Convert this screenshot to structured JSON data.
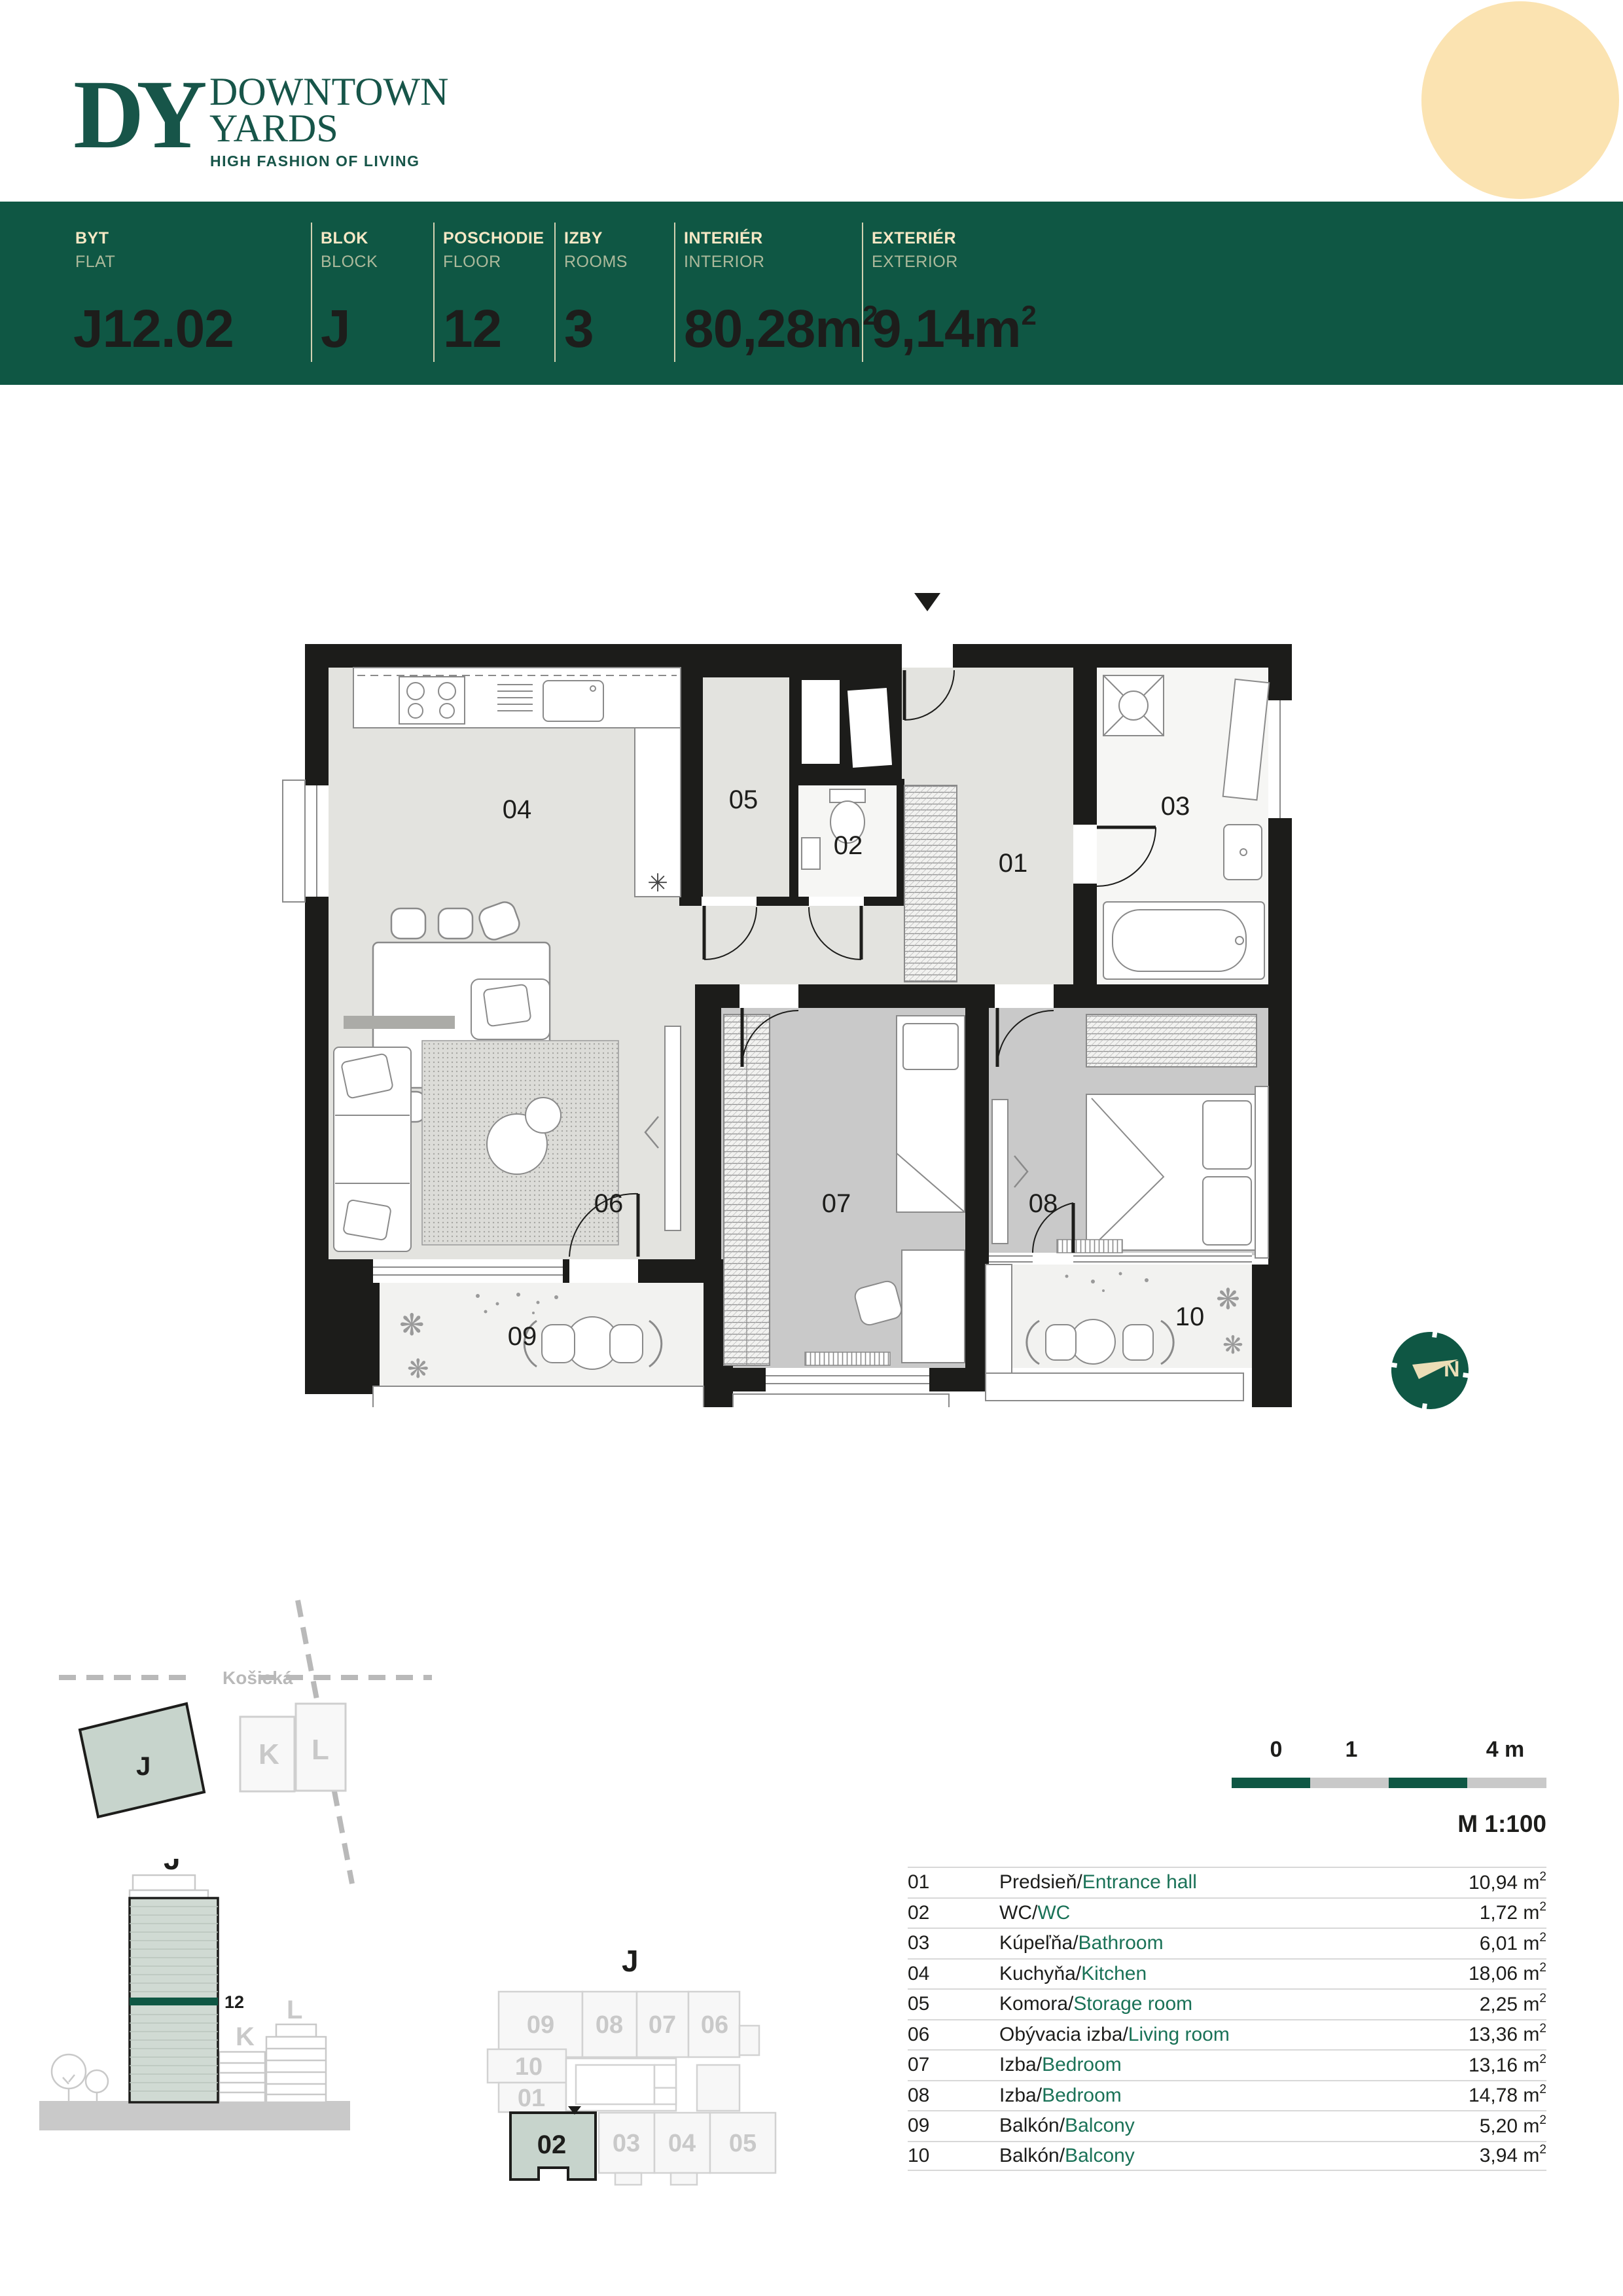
{
  "colors": {
    "brand_green": "#0F5744",
    "logo_green": "#175549",
    "accent_green": "#1A7257",
    "cream": "#F6E8C5",
    "peach": "#FBE3B1",
    "sage": "#C7D4CC",
    "floor_light": "#E3E3DF",
    "floor_dark": "#C9C9C9",
    "wall": "#1C1C1A"
  },
  "logo": {
    "monogram": "DY",
    "line1": "DOWNTOWN",
    "line2": "YARDS",
    "tagline": "HIGH FASHION OF LIVING"
  },
  "header": {
    "flat": {
      "label_sk": "BYT",
      "label_en": "FLAT",
      "value": "J12.02"
    },
    "block": {
      "label_sk": "BLOK",
      "label_en": "BLOCK",
      "value": "J"
    },
    "floor": {
      "label_sk": "POSCHODIE",
      "label_en": "FLOOR",
      "value": "12"
    },
    "rooms": {
      "label_sk": "IZBY",
      "label_en": "ROOMS",
      "value": "3"
    },
    "interior": {
      "label_sk": "INTERIÉR",
      "label_en": "INTERIOR",
      "value": "80,28m",
      "exp": "2",
      "full": "80,28m²"
    },
    "exterior": {
      "label_sk": "EXTERIÉR",
      "label_en": "EXTERIOR",
      "value": "9,14m",
      "exp": "2",
      "full": "9,14m²"
    }
  },
  "plan": {
    "rooms": {
      "r01": "01",
      "r02": "02",
      "r03": "03",
      "r04": "04",
      "r05": "05",
      "r06": "06",
      "r07": "07",
      "r08": "08",
      "r09": "09",
      "r10": "10"
    },
    "kitchen_symbol": "✳",
    "plant_symbol": "❋"
  },
  "compass": {
    "north": "N"
  },
  "site": {
    "street": "Košická",
    "block_j": "J",
    "block_k": "K",
    "block_l": "L"
  },
  "elevation": {
    "building": "J",
    "floor": "12",
    "block_k": "K",
    "block_l": "L"
  },
  "floorplate": {
    "building": "J",
    "highlight": "02",
    "f09": "09",
    "f08": "08",
    "f07": "07",
    "f06": "06",
    "f10": "10",
    "f01": "01",
    "f03": "03",
    "f04": "04",
    "f05": "05"
  },
  "scalebar": {
    "t0": "0",
    "t1": "1",
    "t4": "4 m",
    "scale": "M 1:100"
  },
  "legend": {
    "sep": "/",
    "unit": "m",
    "exp": "2",
    "rows": [
      {
        "num": "01",
        "sk": "Predsieň",
        "en": "Entrance hall",
        "area": "10,94"
      },
      {
        "num": "02",
        "sk": "WC",
        "en": "WC",
        "area": "1,72"
      },
      {
        "num": "03",
        "sk": "Kúpeľňa",
        "en": "Bathroom",
        "area": "6,01"
      },
      {
        "num": "04",
        "sk": "Kuchyňa",
        "en": "Kitchen",
        "area": "18,06"
      },
      {
        "num": "05",
        "sk": "Komora",
        "en": "Storage room",
        "area": "2,25"
      },
      {
        "num": "06",
        "sk": "Obývacia izba",
        "en": "Living room",
        "area": "13,36"
      },
      {
        "num": "07",
        "sk": "Izba",
        "en": "Bedroom",
        "area": "13,16"
      },
      {
        "num": "08",
        "sk": "Izba",
        "en": "Bedroom",
        "area": "14,78"
      },
      {
        "num": "09",
        "sk": "Balkón",
        "en": "Balcony",
        "area": "5,20"
      },
      {
        "num": "10",
        "sk": "Balkón",
        "en": "Balcony",
        "area": "3,94"
      }
    ]
  }
}
